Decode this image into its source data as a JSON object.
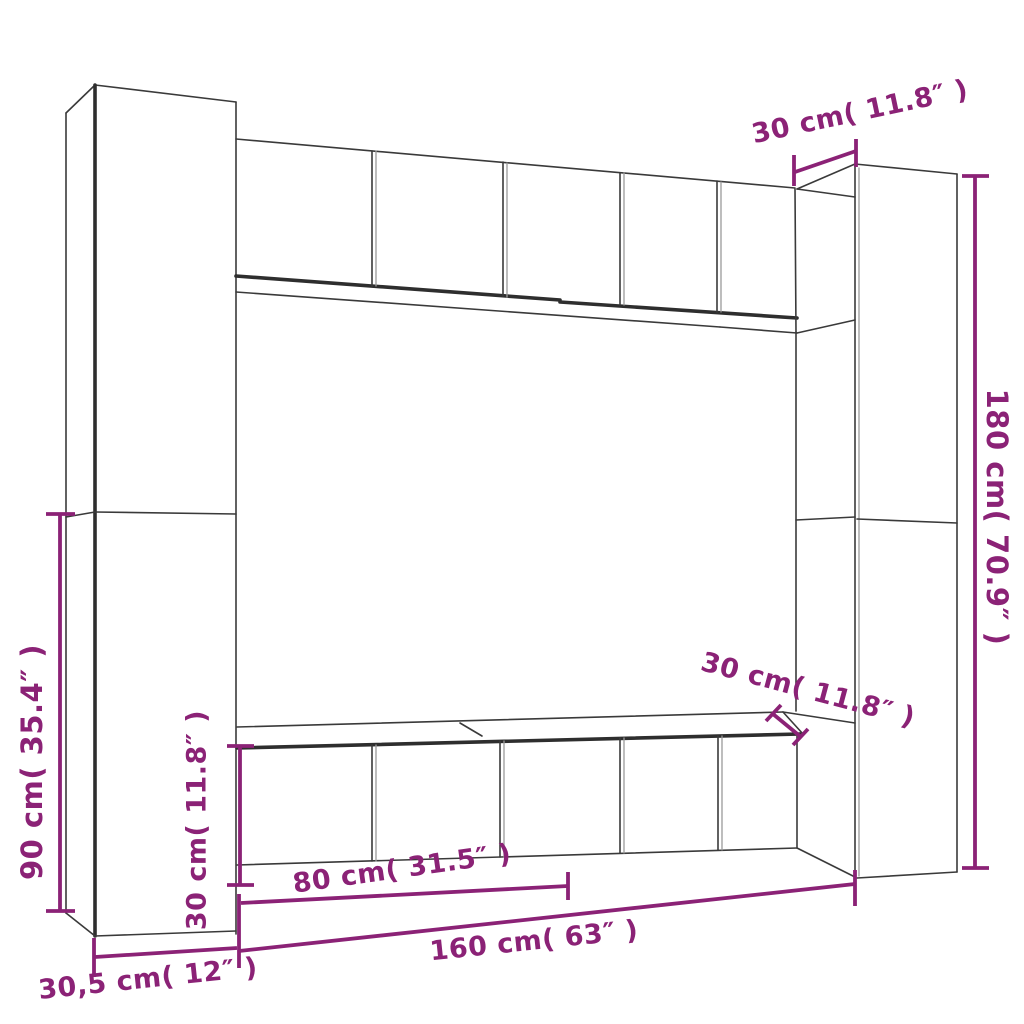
{
  "diagram": {
    "description_labels": {
      "top_depth_label": "30 cm( 11.8″ )",
      "right_height_label": "180 cm( 70.9″ )",
      "middle_depth_label": "30 cm( 11.8″ )",
      "left_lower_height_label": "90 cm( 35.4″ )",
      "bottom_left_height_label": "30 cm( 11.8″ )",
      "bottom_half_width_label": "80 cm( 31.5″ )",
      "bottom_full_width_label": "160 cm( 63″ )",
      "side_depth_label": "30,5 cm( 12″ )"
    },
    "colors": {
      "dimension_accent": "#8B2276",
      "outline": "#3a3a3a",
      "background": "#ffffff"
    }
  }
}
